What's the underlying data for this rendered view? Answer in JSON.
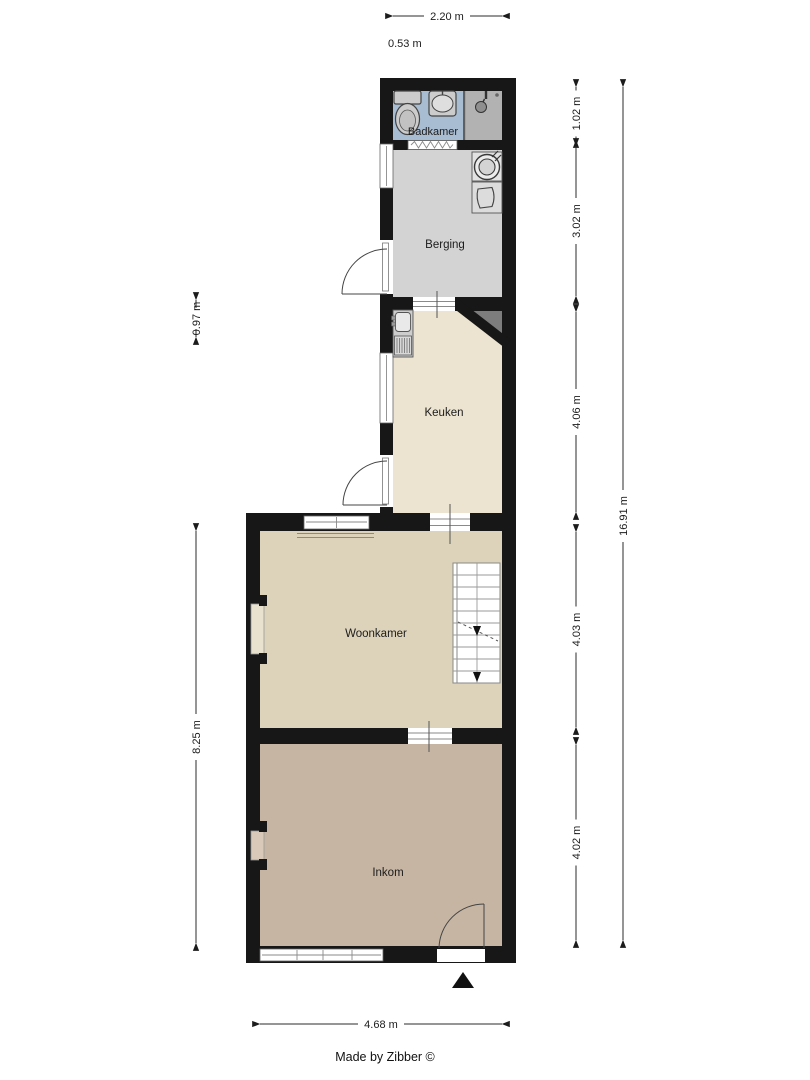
{
  "plan": {
    "type": "floorplan",
    "footer": "Made by Zibber ©"
  },
  "rooms": [
    {
      "id": "badkamer",
      "label": "Badkamer"
    },
    {
      "id": "berging",
      "label": "Berging"
    },
    {
      "id": "keuken",
      "label": "Keuken"
    },
    {
      "id": "woonkamer",
      "label": "Woonkamer"
    },
    {
      "id": "inkom",
      "label": "Inkom"
    }
  ],
  "dimensions": {
    "top_width": "2.20 m",
    "top_offset": "0.53 m",
    "right_segments": [
      "1.02 m",
      "3.02 m",
      "4.06 m",
      "4.03 m",
      "4.02 m"
    ],
    "right_total": "16.91 m",
    "left_upper": "0.97 m",
    "left_lower": "8.25 m",
    "bottom_width": "4.68 m"
  },
  "fixtures": [
    "toilet",
    "bathroom-sink",
    "shower",
    "folding-door",
    "washing-machine",
    "boiler",
    "kitchen-counter",
    "stairs",
    "entrance-arrow"
  ],
  "colors": {
    "wall": "#171717",
    "badkamer_floor": "#a9bdd2",
    "shower_floor": "#b2b2b2",
    "berging_floor": "#d3d3d3",
    "keuken_floor": "#ece4d0",
    "woonkamer_floor": "#ddd3bb",
    "inkom_floor": "#c6b5a2",
    "chamfer_shadow": "#7d7d7d"
  }
}
